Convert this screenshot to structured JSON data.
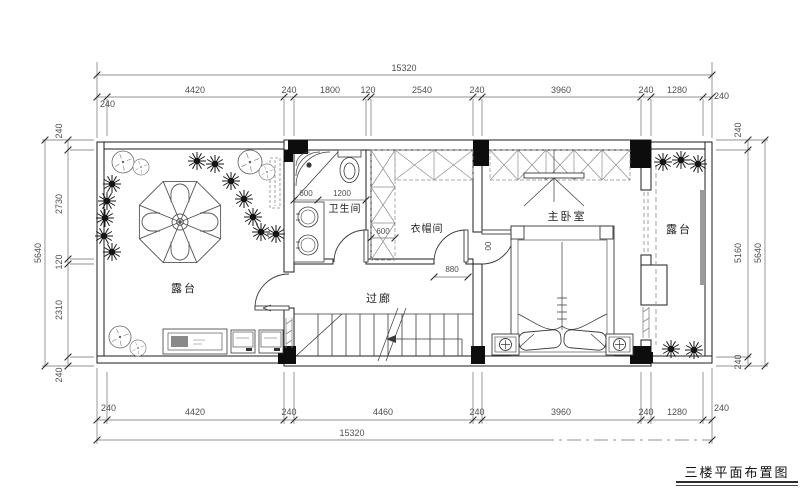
{
  "drawing": {
    "title": "三楼平面布置图",
    "rooms": {
      "terrace_left": "露台",
      "bathroom": "卫生间",
      "cloakroom": "衣帽间",
      "corridor": "过廊",
      "bedroom": "主卧室",
      "terrace_right": "露台"
    },
    "dims": {
      "top": {
        "total": "15320",
        "segments": [
          "240",
          "4420",
          "240",
          "1800",
          "120",
          "2540",
          "240",
          "3960",
          "240",
          "1280",
          "240"
        ]
      },
      "bottom": {
        "total": "15320",
        "segments": [
          "240",
          "4420",
          "240",
          "4460",
          "240",
          "3960",
          "240",
          "1280",
          "240"
        ]
      },
      "left": {
        "total": "5640",
        "segments": [
          "240",
          "2730",
          "120",
          "2310",
          "240"
        ]
      },
      "right": {
        "total": "5640",
        "segments": [
          "240",
          "5160",
          "240"
        ]
      },
      "interior": {
        "shower": "600",
        "toilet": "1200",
        "closet": "600",
        "door": "880",
        "partial": "00"
      }
    },
    "colors": {
      "wall": "#1c1c1c",
      "dim": "#5a5a5a",
      "fixture": "#3a3a3a",
      "closet": "#8c8c8c",
      "background": "#ffffff"
    }
  }
}
